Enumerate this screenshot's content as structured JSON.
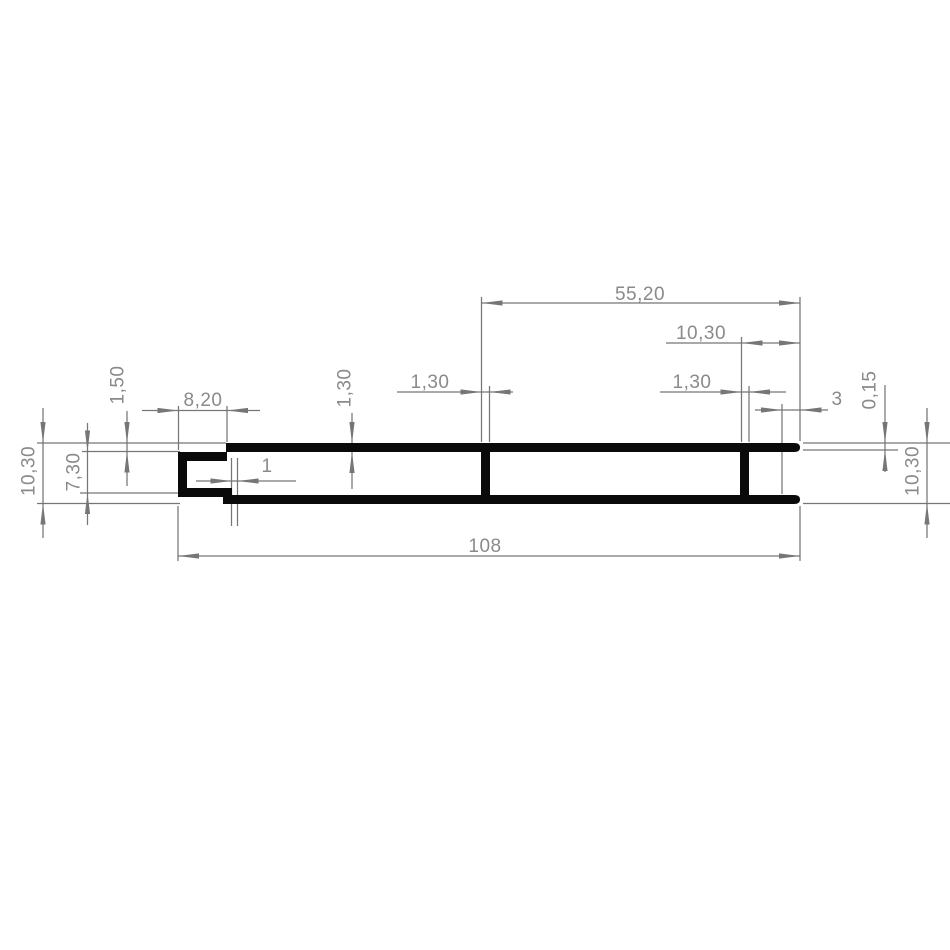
{
  "drawing": {
    "title": "profile-cross-section-technical-drawing",
    "units": "mm",
    "labels": {
      "total_length": "108",
      "right_span": "55,20",
      "right_end_to_web": "10,30",
      "mid_web_thickness": "1,30",
      "right_web_thickness": "1,30",
      "wall_thickness": "1,30",
      "end_lip_length": "3",
      "end_lip_offset": "0,15",
      "height_right": "10,30",
      "height_left": "10,30",
      "channel_inner_height": "7,30",
      "channel_top_offset": "1,50",
      "channel_depth": "8,20",
      "channel_step": "1"
    }
  }
}
